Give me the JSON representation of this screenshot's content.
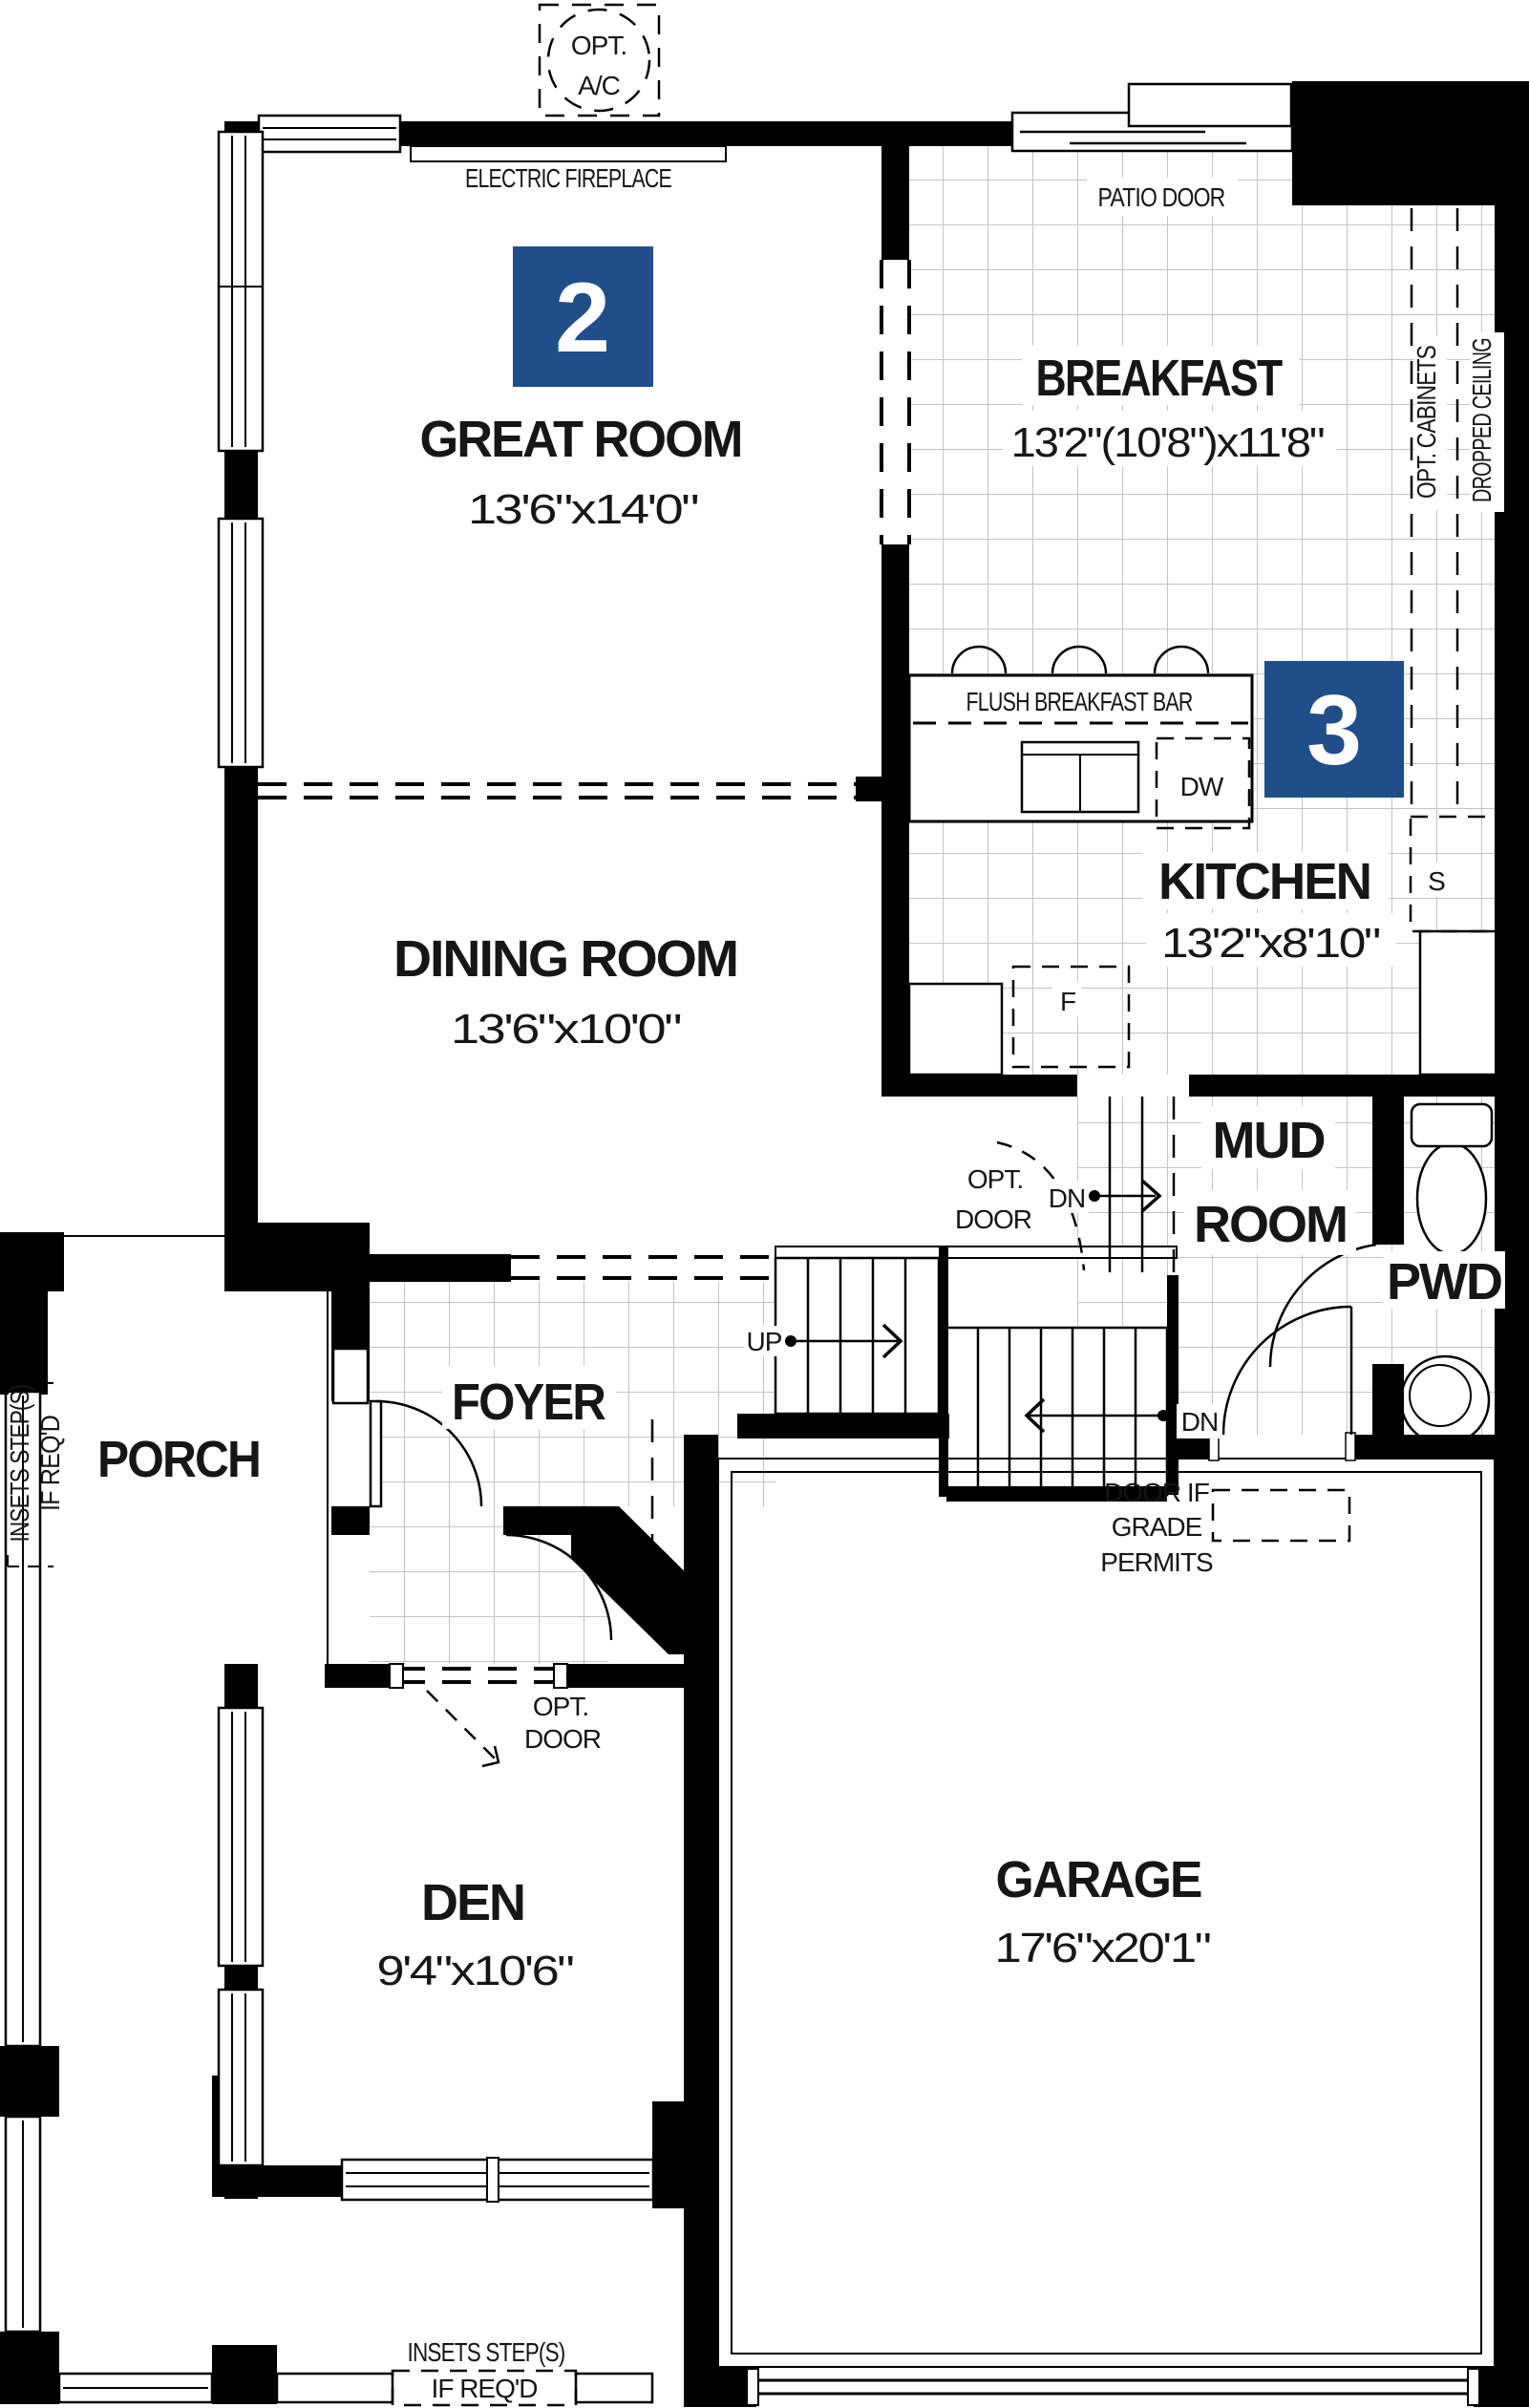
{
  "plan": {
    "accent_color": "#1f4e8a",
    "badges": {
      "great_room": "2",
      "kitchen": "3"
    },
    "rooms": {
      "great_room": {
        "label": "GREAT ROOM",
        "dims": "13'6\"x14'0\""
      },
      "breakfast": {
        "label": "BREAKFAST",
        "dims": "13'2\"(10'8\")x11'8\""
      },
      "kitchen": {
        "label": "KITCHEN",
        "dims": "13'2\"x8'10\""
      },
      "dining_room": {
        "label": "DINING ROOM",
        "dims": "13'6\"x10'0\""
      },
      "mud_room": {
        "line1": "MUD",
        "line2": "ROOM"
      },
      "pwd": {
        "label": "PWD"
      },
      "foyer": {
        "label": "FOYER"
      },
      "porch": {
        "label": "PORCH"
      },
      "den": {
        "label": "DEN",
        "dims": "9'4\"x10'6\""
      },
      "garage": {
        "label": "GARAGE",
        "dims": "17'6\"x20'1\""
      }
    },
    "annotations": {
      "opt_ac_1": "OPT.",
      "opt_ac_2": "A/C",
      "electric_fireplace": "ELECTRIC FIREPLACE",
      "patio_door": "PATIO DOOR",
      "opt_cabinets": "OPT. CABINETS",
      "dropped_ceiling": "DROPPED CEILING",
      "flush_breakfast_bar": "FLUSH BREAKFAST BAR",
      "dishwasher": "DW",
      "sink_s": "S",
      "fridge_f": "F",
      "up": "UP",
      "down": "DN",
      "opt": "OPT.",
      "door": "DOOR",
      "door_if_1": "DOOR IF",
      "door_if_2": "GRADE",
      "door_if_3": "PERMITS",
      "insets_1": "INSETS STEP(S)",
      "insets_2": "IF REQ'D"
    }
  }
}
